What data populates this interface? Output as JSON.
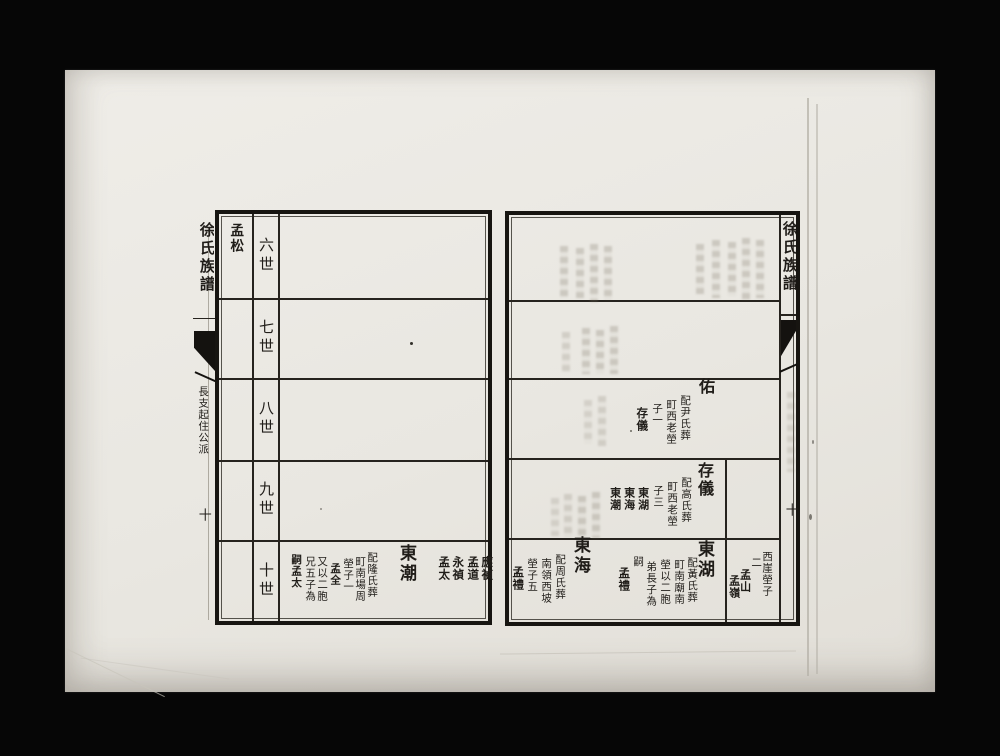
{
  "photo": {
    "background_color": "#060606",
    "paper_color": "#e9e7e1",
    "ink_color": "#1d1b18"
  },
  "left_page": {
    "spine": {
      "title": "徐氏族譜",
      "section_label": "長支起住公派",
      "page_mark": "十"
    },
    "branch_label": "孟松",
    "generations": [
      "六世",
      "七世",
      "八世",
      "九世",
      "十世"
    ],
    "row_ten": {
      "carryover_names": [
        "應禎",
        "孟道",
        "永禎",
        "孟太"
      ],
      "entry": {
        "name": "東潮",
        "note": [
          "配隆氏葬",
          "町南場周",
          "塋子一",
          "孟全",
          "又以二胞",
          "兄五子為",
          "嗣孟太"
        ]
      }
    }
  },
  "right_page": {
    "banxin": {
      "title": "徐氏族譜",
      "page_number": "十"
    },
    "row_eight": {
      "entry": {
        "name": "佑",
        "note": [
          "配尹氏葬",
          "町西老塋",
          "子一",
          "存儀"
        ]
      }
    },
    "row_nine": {
      "entry": {
        "name": "存儀",
        "note": [
          "配高氏葬",
          "町西老塋",
          "子三",
          "東湖",
          "東海",
          "東潮"
        ]
      }
    },
    "row_ten": {
      "margin_note": [
        "西崖塋子",
        "二",
        "孟山",
        "孟嶺"
      ],
      "entry_donghu": {
        "name": "東湖",
        "note": [
          "配黃氏葬",
          "町南廟南",
          "塋以二胞",
          "弟長子為",
          "嗣",
          "孟禮"
        ]
      },
      "entry_donghai": {
        "name": "東海",
        "note": [
          "配周氏葬",
          "南領西坡",
          "塋子五",
          "孟禮"
        ]
      }
    }
  }
}
